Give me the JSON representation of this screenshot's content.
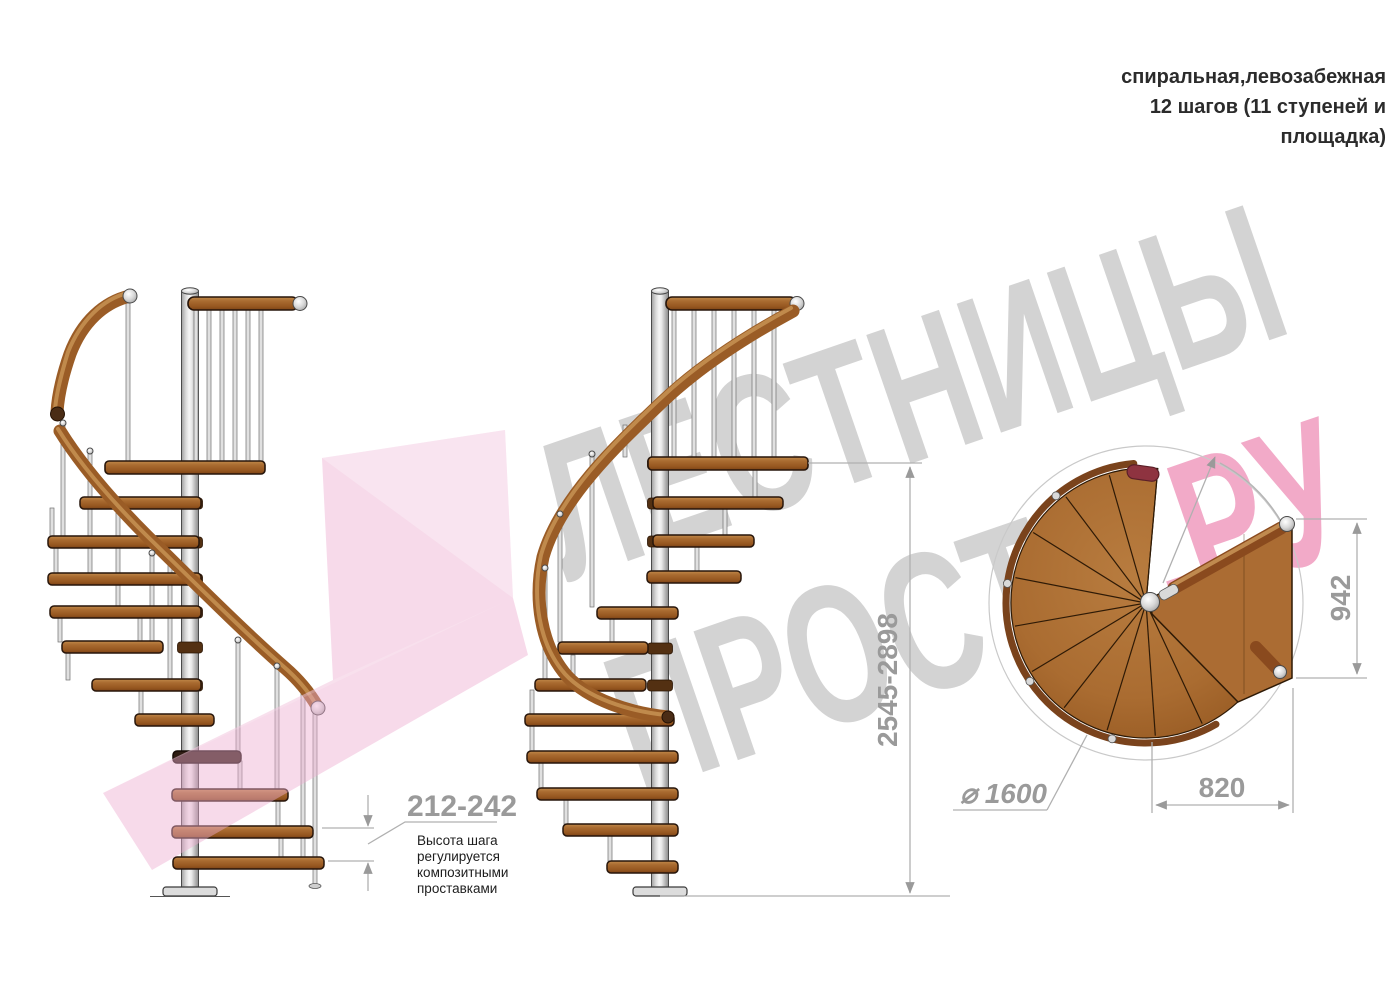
{
  "title": {
    "line1": "спиральная,левозабежная",
    "line2": "12 шагов (11 ступеней и",
    "line3": "площадка)"
  },
  "watermark": {
    "line1": "ЛЕСТНИЦЫ",
    "line2_gray": "ПРОСТО",
    "line2_pink": ".РУ"
  },
  "dimensions": {
    "step_height": "212-242",
    "note_line1": "Высота шага",
    "note_line2": "регулируется",
    "note_line3": "композитными",
    "note_line4": "проставками",
    "total_height": "2545-2898",
    "platform_depth": "942",
    "platform_width": "820",
    "diameter_label": "⌀ 1600"
  },
  "colors": {
    "wood": "#9a5f28",
    "wood_dark": "#6e3c15",
    "metal": "#e0e0e0",
    "dim_gray": "#9a9a9a",
    "watermark_gray": "#d3d3d3",
    "watermark_pink": "#f2aac8",
    "logo_pink": "#eeaed0",
    "text_dark": "#2b2b2b"
  }
}
